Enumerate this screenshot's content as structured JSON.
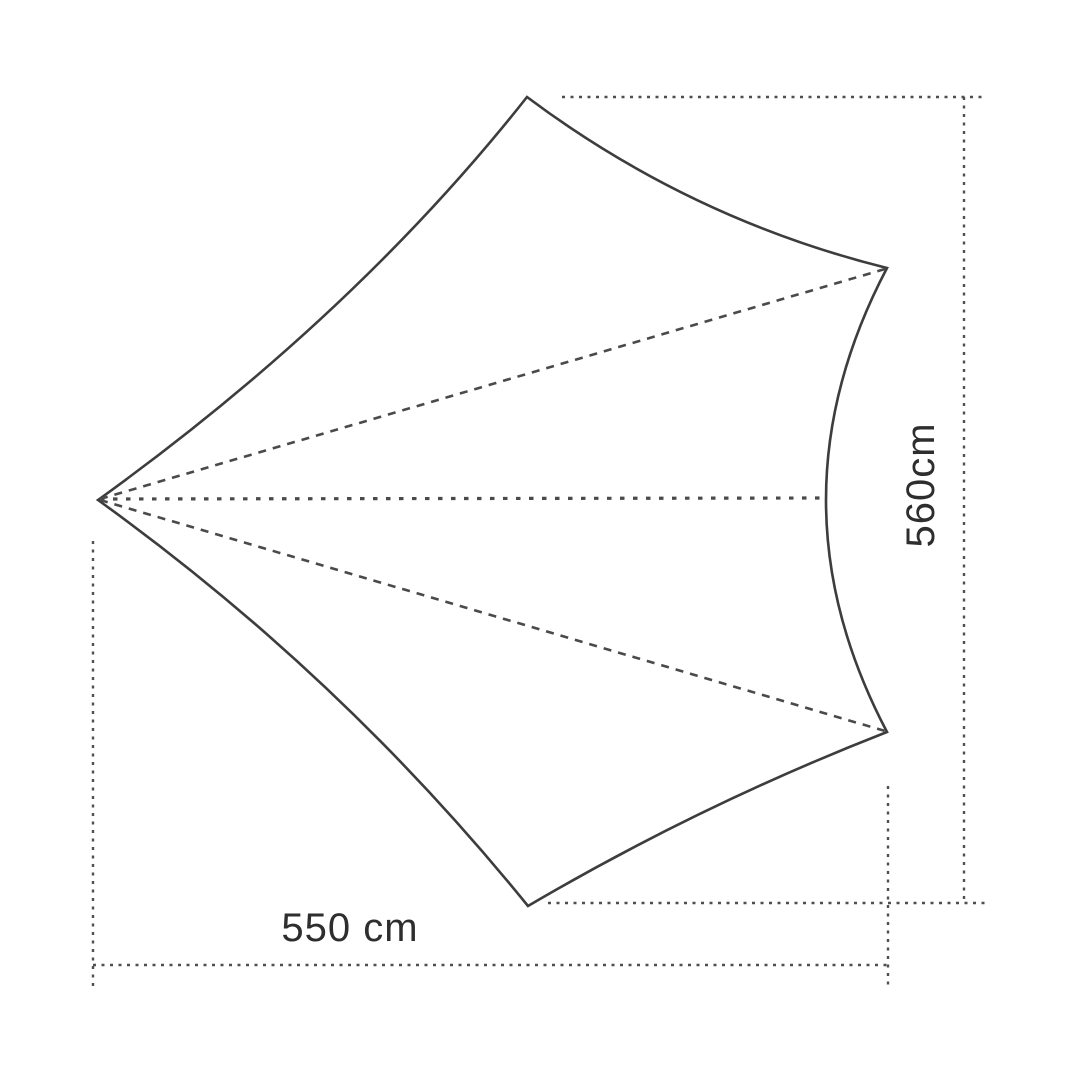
{
  "figure": {
    "kind": "tarp-dimension-diagram",
    "dimensions": {
      "width_label": "550 cm",
      "width_value_cm": 550,
      "height_label": "560cm",
      "height_value_cm": 560,
      "unit": "cm"
    }
  },
  "colors": {
    "background": "#ffffff",
    "outline": "#3d3d3d",
    "guide": "#4a4a4a",
    "dimension": "#4f4f4f",
    "label": "#2e2e2e"
  }
}
